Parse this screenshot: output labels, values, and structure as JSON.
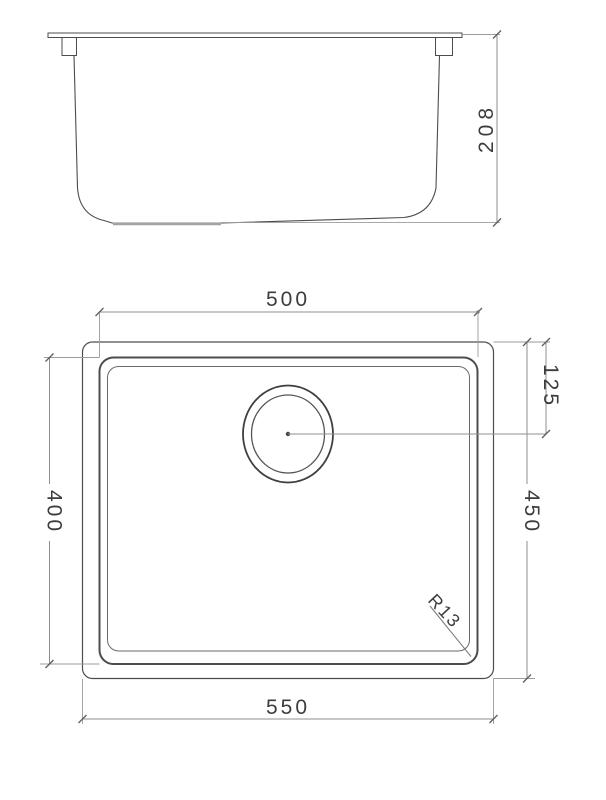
{
  "labels": {
    "side_height": "208",
    "bowl_width": "500",
    "drain_offset": "125",
    "bowl_depth": "400",
    "overall_depth": "450",
    "overall_width": "550",
    "corner_radius": "R13"
  },
  "colors": {
    "object_line": "#4d4d4d",
    "dimension_line": "#8f8f8f",
    "text": "#3c3c3c",
    "background": "#ffffff"
  }
}
